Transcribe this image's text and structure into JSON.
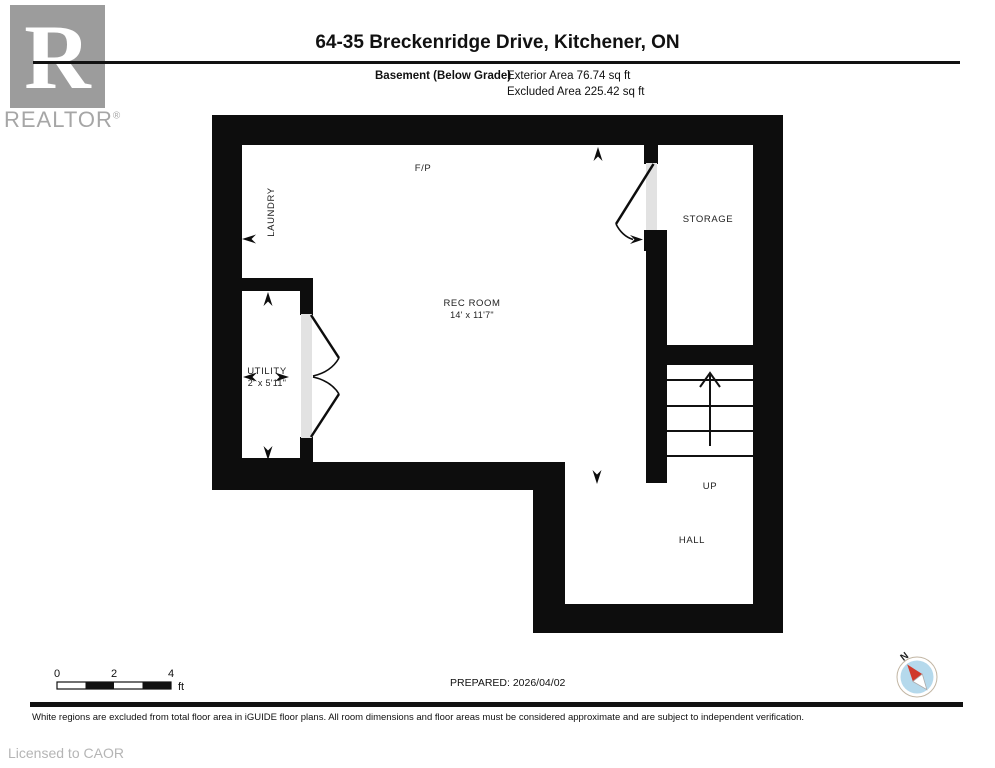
{
  "header": {
    "logo": {
      "letter": "R",
      "brand": "REALTOR",
      "registered": "®"
    },
    "title": "64-35 Breckenridge Drive, Kitchener, ON",
    "floor_label": "Basement (Below Grade)",
    "exterior_area": "Exterior Area 76.74 sq ft",
    "excluded_area": "Excluded Area 225.42 sq ft"
  },
  "plan": {
    "rooms": {
      "fireplace": "F/P",
      "laundry": "LAUNDRY",
      "storage": "STORAGE",
      "rec_room_name": "REC ROOM",
      "rec_room_dims": "14' x 11'7\"",
      "utility_name": "UTILITY",
      "utility_dims": "2' x 5'11\"",
      "stairs_direction": "UP",
      "hall": "HALL"
    }
  },
  "scale_bar": {
    "tick_0": "0",
    "tick_2": "2",
    "tick_4": "4",
    "unit": "ft"
  },
  "prepared": "PREPARED: 2026/04/02",
  "compass": {
    "north_label": "N"
  },
  "disclaimer": "White regions are excluded from total floor area in iGUIDE floor plans. All room dimensions and floor areas must be considered approximate and are subject to independent verification.",
  "license": "Licensed to CAOR",
  "colors": {
    "wall": "#0d0d0d",
    "door_gap": "#e2e2e2",
    "logo_gray": "#9c9c9c",
    "logo_text_gray": "#a6a6a6",
    "compass_disc": "#b5d9ec",
    "compass_needle_red": "#d03a2b",
    "license_gray": "#b5b5b5"
  }
}
